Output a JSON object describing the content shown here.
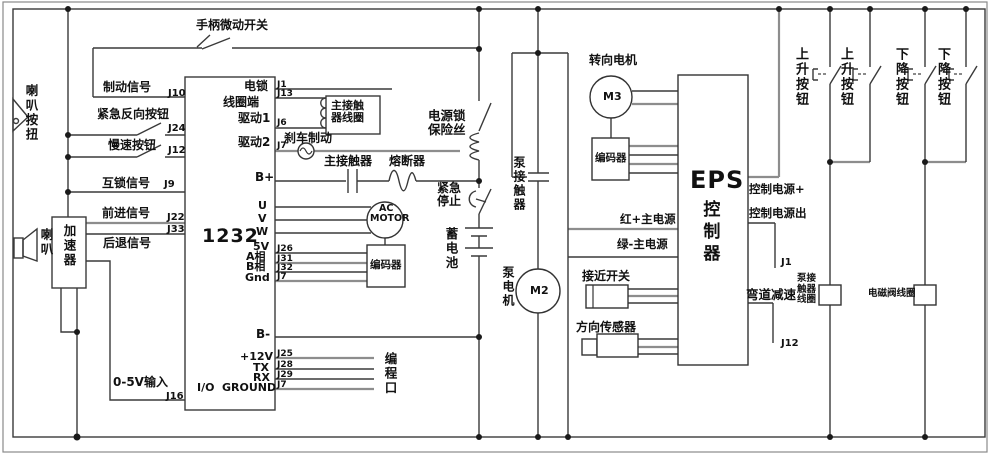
{
  "labels": {
    "handle_micro_switch": "手柄微动开关",
    "horn_button": "喇叭按扭",
    "horn": "喇叭",
    "accelerator": "加速器",
    "brake_signal": "制动信号",
    "emergency_reverse_button": "紧急反向按钮",
    "slow_button": "慢速按钮",
    "interlock_signal": "互锁信号",
    "forward_signal": "前进信号",
    "backward_signal": "后退信号",
    "input_0_5v": "0-5V输入",
    "controller_model": "1232",
    "io_port": "I/O",
    "ground": "GROUND",
    "lock_coil_line1": "电锁",
    "lock_coil_line2": "线圈端",
    "drive1": "驱动1",
    "drive2": "驱动2",
    "b_plus": "B+",
    "b_minus": "B-",
    "u": "U",
    "v": "V",
    "w": "W",
    "v5": "5V",
    "phase_a": "A相",
    "phase_b": "B相",
    "gnd": "Gnd",
    "p12v": "+12V",
    "tx": "TX",
    "rx": "RX",
    "programming_port": "编程口",
    "main_contactor_coil": "主接触器线圈",
    "brake": "刹车制动",
    "main_contactor": "主接触器",
    "fuse": "熔断器",
    "power_lock_fuse": "电源锁保险丝",
    "emergency_stop": "紧急停止",
    "battery": "蓄电池",
    "pump_contactor": "泵接触器",
    "pump_motor": "泵电机",
    "m2": "M2",
    "ac_line1": "AC",
    "ac_line2": "MOTOR",
    "encoder": "编码器",
    "steering_motor": "转向电机",
    "m3": "M3",
    "eps_title": "EPS",
    "eps_subtitle": "控制器",
    "red_main_power": "红+主电源",
    "green_main_power": "绿-主电源",
    "proximity_switch": "接近开关",
    "direction_sensor": "方向传感器",
    "control_power_plus": "控制电源+",
    "control_power_out": "控制电源出",
    "curve_deceleration": "弯道减速",
    "pump_contactor_coil": "泵接触器线圈",
    "solenoid_valve_coil": "电磁阀线圈",
    "up_button": "上升按钮",
    "down_button": "下降按钮"
  },
  "pins": {
    "j1": "J1",
    "j6": "J6",
    "j7": "J7",
    "j9": "J9",
    "j10": "J10",
    "j12": "J12",
    "j13": "J13",
    "j16": "J16",
    "j22": "J22",
    "j24": "J24",
    "j25": "J25",
    "j26": "J26",
    "j28": "J28",
    "j29": "J29",
    "j31": "J31",
    "j32": "J32",
    "j33": "J33"
  }
}
